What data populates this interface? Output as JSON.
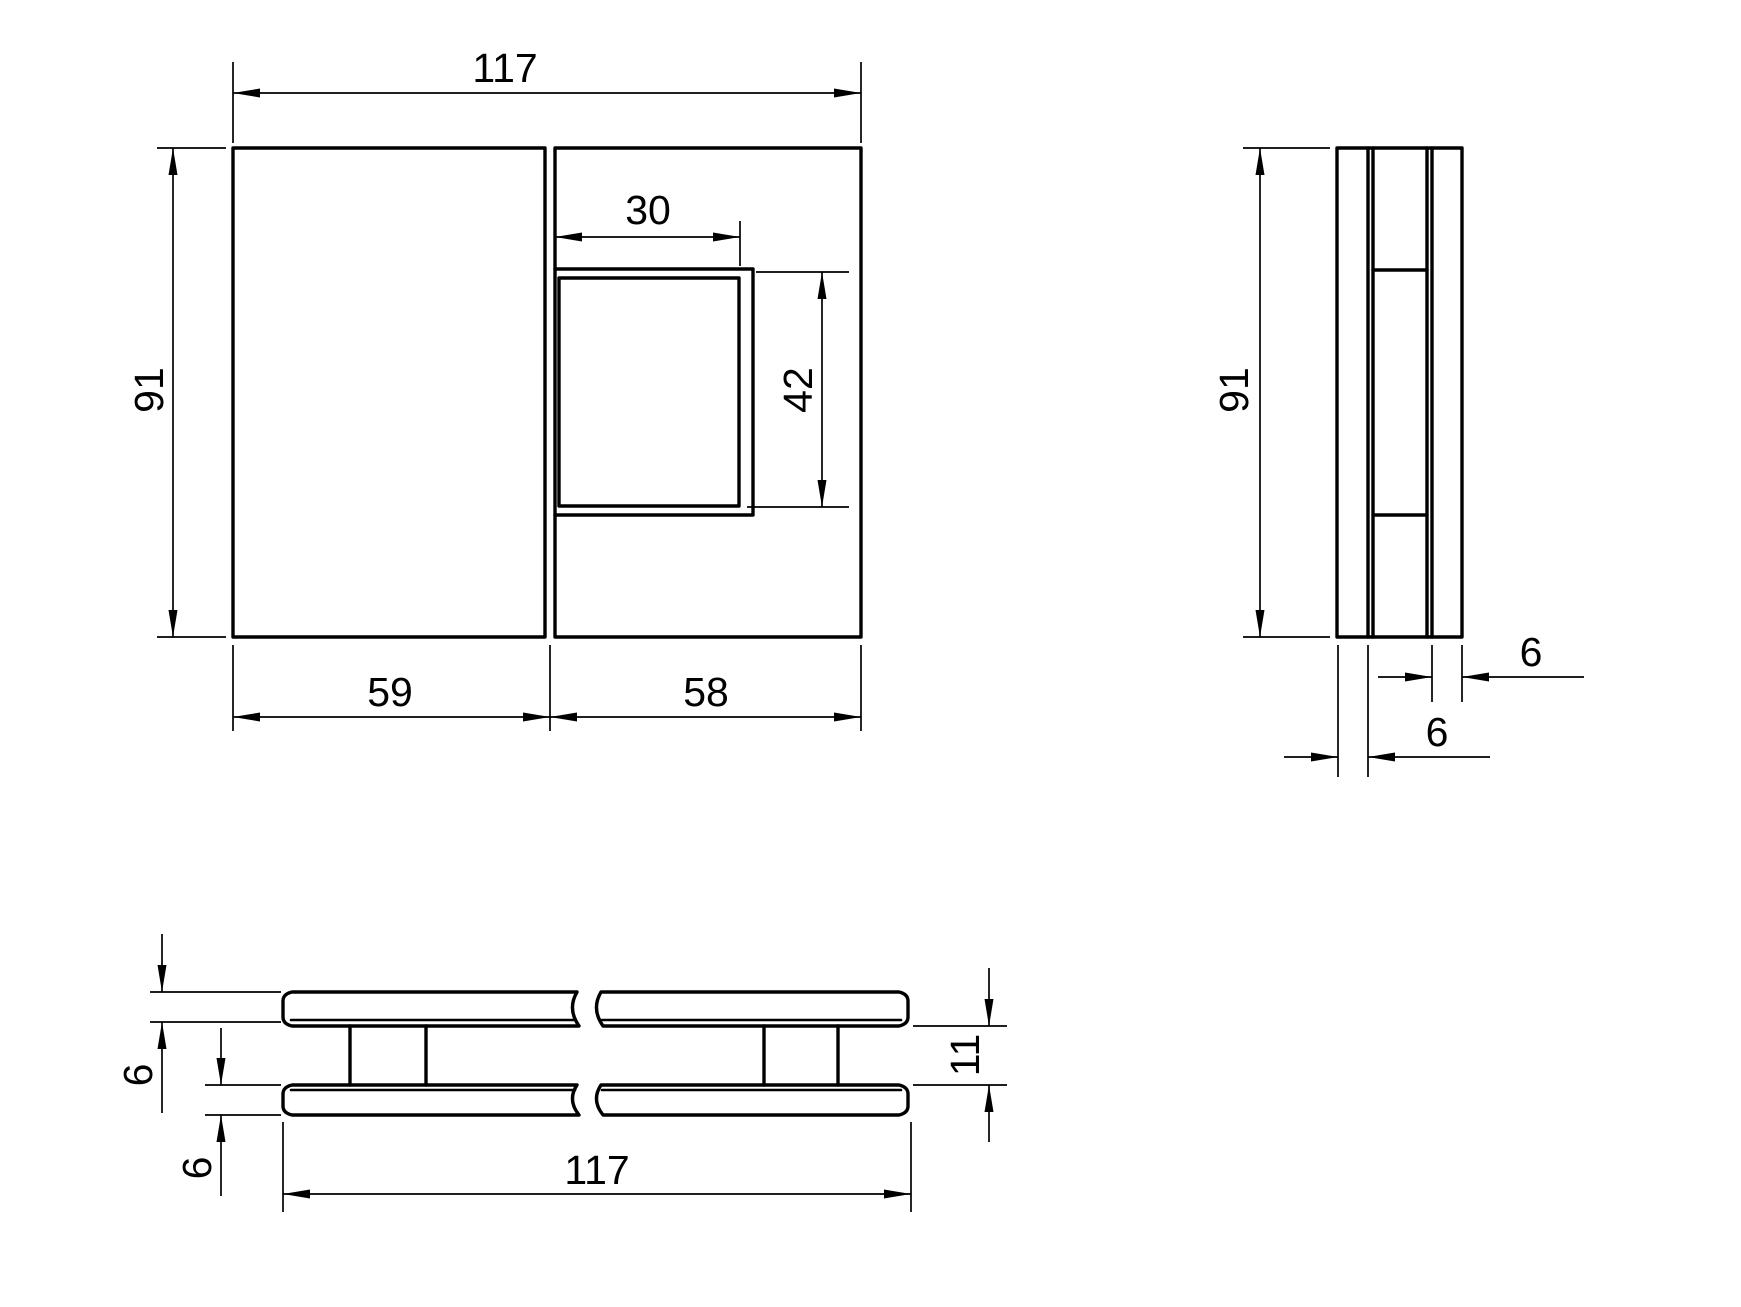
{
  "drawing": {
    "background_color": "#ffffff",
    "line_color": "#000000",
    "views": {
      "front_view": {
        "dimensions": {
          "overall_width": "117",
          "overall_height": "91",
          "cutout_width": "30",
          "cutout_height": "42",
          "left_panel_width": "59",
          "right_panel_width": "58"
        }
      },
      "side_view": {
        "dimensions": {
          "overall_height": "91",
          "right_plate_thickness": "6",
          "left_plate_thickness": "6"
        }
      },
      "section_view": {
        "dimensions": {
          "top_plate_thickness": "6",
          "bottom_plate_thickness": "6",
          "plate_gap": "11",
          "overall_width": "117"
        }
      }
    }
  }
}
